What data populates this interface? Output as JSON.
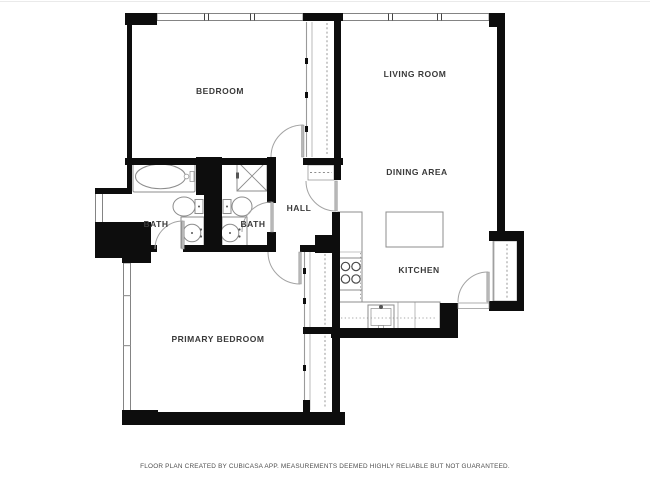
{
  "labels": {
    "bedroom": "BEDROOM",
    "living_room": "LIVING ROOM",
    "dining_area": "DINING AREA",
    "hall": "HALL",
    "bath_left": "BATH",
    "bath_right": "BATH",
    "kitchen": "KITCHEN",
    "primary_bedroom": "PRIMARY BEDROOM"
  },
  "footer": {
    "disclaimer": "FLOOR PLAN CREATED BY CUBICASA APP. MEASUREMENTS DEEMED HIGHLY RELIABLE BUT NOT GUARANTEED."
  },
  "colors": {
    "background": "#ffffff",
    "wall": "#0d0d0d",
    "fixture": "#8d8d8d",
    "door": "#a3a3a3",
    "label_text": "#3a3a3a",
    "footer_text": "#4f4f4f"
  }
}
